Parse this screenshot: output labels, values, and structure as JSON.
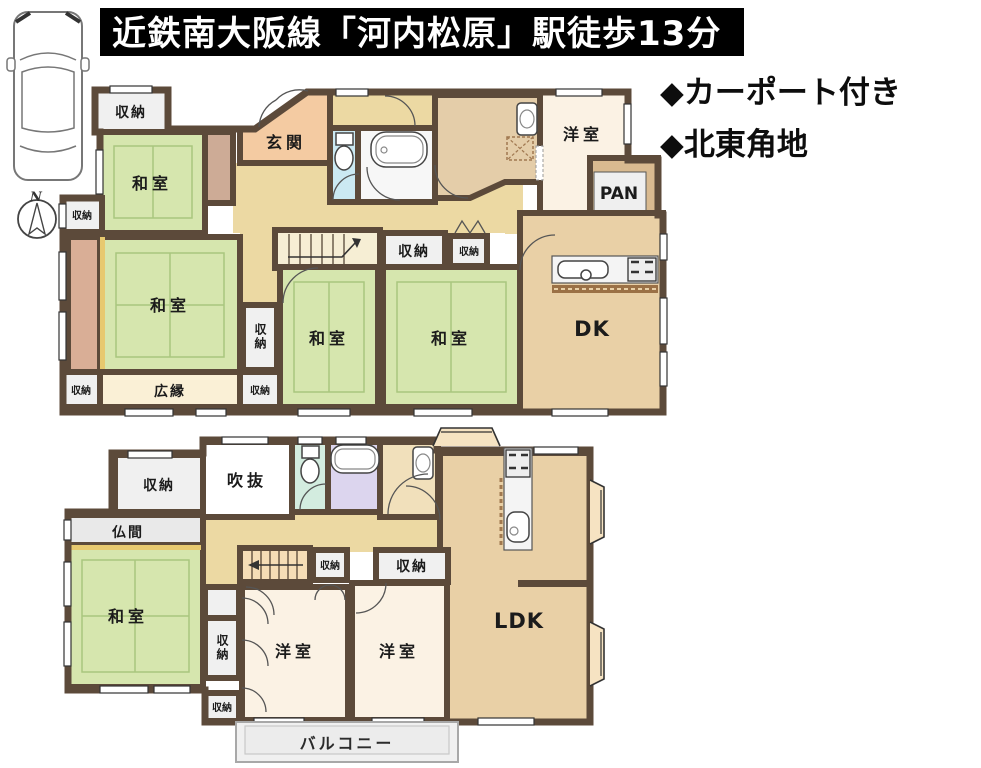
{
  "header": {
    "banner": "近鉄南大阪線「河内松原」駅徒歩13分",
    "features": [
      "◆カーポート付き",
      "◆北東角地"
    ]
  },
  "compass": {
    "north": "N"
  },
  "rooms": {
    "storage": "収納",
    "japanese_room": "和室",
    "entrance": "玄関",
    "western_room": "洋室",
    "pantry": "PAN",
    "dining_kitchen": "DK",
    "living_dining_kitchen": "LDK",
    "veranda": "広縁",
    "atrium": "吹抜",
    "buddhist_room": "仏間",
    "balcony": "バルコニー"
  },
  "colors": {
    "wall": "#5c4a3a",
    "tatami_green": "#d6e6ae",
    "hall_tan": "#ecd9a3",
    "dk_floor": "#e9d0a6",
    "entry_peach": "#f4cba2",
    "western_cream": "#fbf2e4",
    "storage_gray": "#f0f0f0",
    "toilet_blue_1f": "#cbe9f2",
    "toilet_green_2f": "#d3ecdf",
    "bath_lavender_2f": "#dcd5ee",
    "engawa_salmon": "#d9ae96",
    "balcony_gray": "#ececec",
    "banner_bg": "#000000",
    "banner_text": "#ffffff"
  }
}
